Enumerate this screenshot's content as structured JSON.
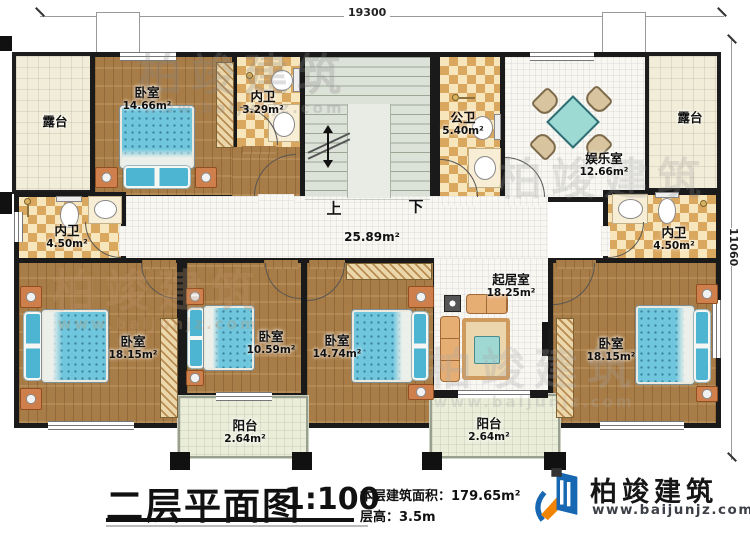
{
  "meta": {
    "plan_width_label": "19300",
    "plan_depth_label": "11060"
  },
  "title_block": {
    "title": "二层平面图",
    "scale": "1:100",
    "area_label": "本层建筑面积：",
    "area_value": "179.65m²",
    "height_label": "层高：",
    "height_value": "3.5m"
  },
  "logo": {
    "company": "柏竣建筑",
    "website": "www.baijunjz.com"
  },
  "watermark": {
    "company": "柏竣建筑",
    "website": "www.baijunjz.com"
  },
  "stairs": {
    "up_label": "上",
    "down_label": "下"
  },
  "hall": {
    "area": "25.89m²"
  },
  "rooms": {
    "terrace_left": {
      "name": "露台"
    },
    "bedroom_top": {
      "name": "卧室",
      "area": "14.66m²"
    },
    "bath_top": {
      "name": "内卫",
      "area": "3.29m²"
    },
    "bath_public": {
      "name": "公卫",
      "area": "5.40m²"
    },
    "entertainment": {
      "name": "娱乐室",
      "area": "12.66m²"
    },
    "terrace_right": {
      "name": "露台"
    },
    "bath_left": {
      "name": "内卫",
      "area": "4.50m²"
    },
    "bath_right": {
      "name": "内卫",
      "area": "4.50m²"
    },
    "bedroom_left": {
      "name": "卧室",
      "area": "18.15m²"
    },
    "bedroom_mid_small": {
      "name": "卧室",
      "area": "10.59m²"
    },
    "bedroom_mid": {
      "name": "卧室",
      "area": "14.74m²"
    },
    "living": {
      "name": "起居室",
      "area": "18.25m²"
    },
    "bedroom_right": {
      "name": "卧室",
      "area": "18.15m²"
    },
    "balcony_left": {
      "name": "阳台",
      "area": "2.64m²"
    },
    "balcony_right": {
      "name": "阳台",
      "area": "2.64m²"
    }
  }
}
